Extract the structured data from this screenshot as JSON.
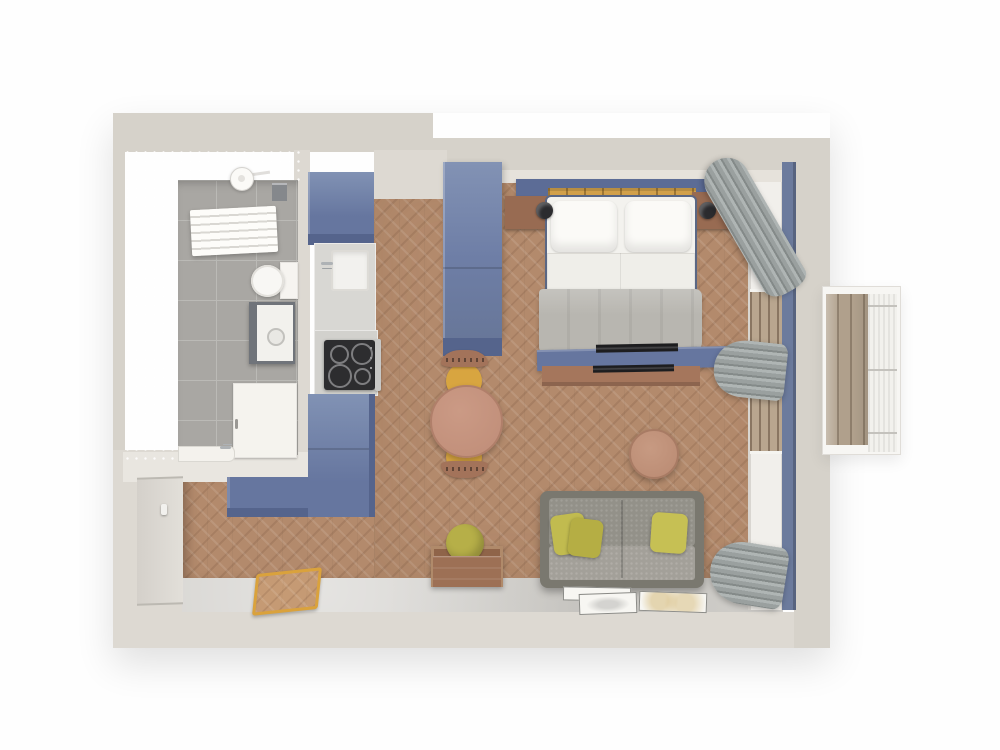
{
  "scene": {
    "type": "3d-floor-plan-top-view",
    "subject": "studio apartment interior render, white and blue tones",
    "rooms": [
      {
        "name": "bathroom",
        "floor": "gray-tile",
        "furniture": [
          "shower-head",
          "towel-radiator",
          "wall-shelf",
          "toilet",
          "washing-machine",
          "cabinet-door",
          "shower-tray",
          "faucet"
        ]
      },
      {
        "name": "kitchen",
        "floor": "wood-herringbone",
        "furniture": [
          "tall-cabinet",
          "sink-counter",
          "sink",
          "faucet",
          "cooktop-counter",
          "cooktop-4-burners",
          "oven-handle",
          "base-cabinet",
          "corner-cabinet"
        ]
      },
      {
        "name": "bedroom",
        "floor": "wood-herringbone",
        "furniture": [
          "wardrobe",
          "headboard",
          "bed-slats",
          "nightstand-left",
          "lamp-left",
          "nightstand-right",
          "lamp-right",
          "double-bed",
          "pillows",
          "gray-blanket",
          "tv-bench",
          "flat-tv"
        ]
      },
      {
        "name": "living-area",
        "floor": "wood-herringbone",
        "furniture": [
          "round-dining-table",
          "dining-chair-top",
          "dining-chair-bottom",
          "round-coffee-table",
          "storage-box-with-cushion",
          "gray-sofa",
          "yellow-pillows",
          "floor-papers"
        ]
      },
      {
        "name": "entry",
        "floor": "concrete",
        "furniture": [
          "entrance-door",
          "door-handle",
          "gold-doormat"
        ]
      },
      {
        "name": "window-zone",
        "furniture": [
          "window-band",
          "wood-slat-window-1",
          "wood-slat-window-2",
          "curtain-top",
          "curtain-middle",
          "curtain-bottom",
          "blue-wall-strip"
        ]
      },
      {
        "name": "balcony",
        "floor": "wood-deck",
        "furniture": [
          "deck-planks",
          "white-railing"
        ]
      }
    ]
  },
  "palette": {
    "exterior": "#fefefe",
    "wall": "#d6d2ca",
    "wall-light": "#ddd9d2",
    "wall-face": "#e6e2db",
    "bright-wall": "#f7f4ed",
    "tile": "#a9a7a3",
    "tile-line": "#bbbab6",
    "concrete": "#d3d1cd",
    "wood": "#b38a6c",
    "wood-light": "#c59a74",
    "cab-top": "#8192b4",
    "cab-front": "#66769f",
    "cab-dark": "#55648c",
    "headboard": "#5c6c96",
    "blue-strip": "#6c7b9d",
    "gold-slats": "#d2a14b",
    "nightstand": "#986b52",
    "lamp": "#2b2b2e",
    "mattress": "#f3f2ee",
    "sheet": "#efeee9",
    "blanket": "#b8b6b0",
    "curtain": "#9aa09f",
    "curtain-dark": "#848a89",
    "sofa-frame": "#7a786f",
    "sofa-back": "#939189",
    "sofa-seat": "#a3a099",
    "pillow-yellow": "#c1bb4f",
    "table-wood": "#c2907b",
    "chair-seat": "#d8a540",
    "chair-back": "#a3735a",
    "coffee-table": "#bd8e76",
    "box-wood": "#9d7055",
    "cushion-olive": "#b6af48",
    "cooktop": "#2d2d2f",
    "counter": "#d8d7d3",
    "sink": "#f2f1ee",
    "white-fixture": "#f6f4f0",
    "washer-dark": "#70747a",
    "deck": "#b0a08c",
    "railing": "#f2f1ed",
    "doormat-gold": "#daa23c",
    "paper": "#f7f6f2",
    "tv-black": "#1d1d1f"
  }
}
